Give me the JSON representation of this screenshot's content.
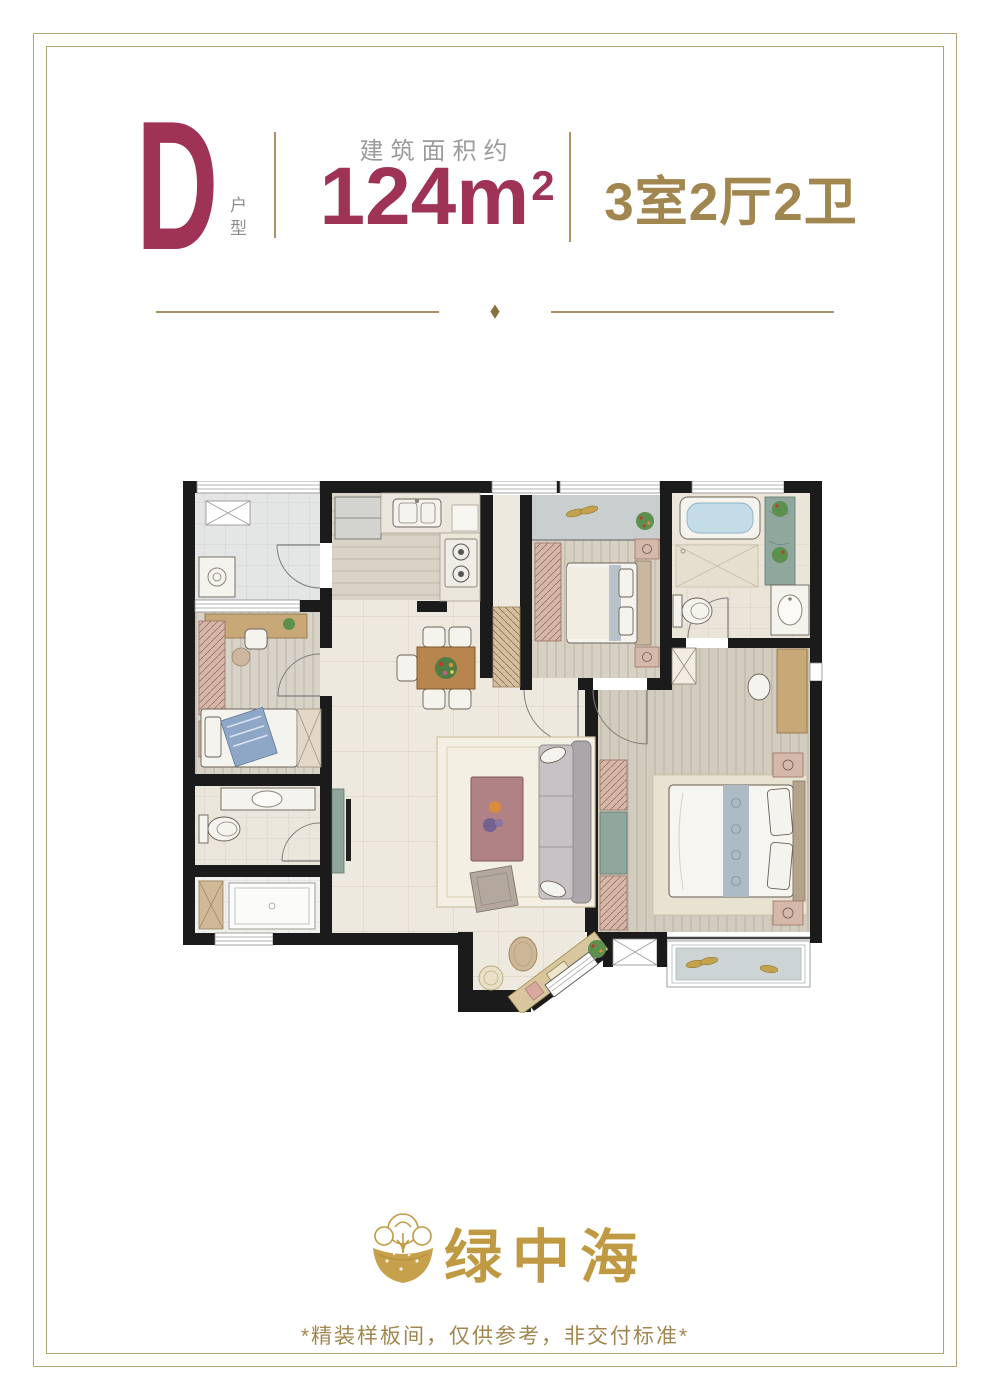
{
  "page": {
    "width": 990,
    "height": 1400,
    "background": "#ffffff",
    "frame_color": "#b6a477"
  },
  "header": {
    "unit_letter": "D",
    "unit_letter_color": "#9e3355",
    "unit_label": "户型",
    "area_caption": "建筑面积约",
    "area_value": "124m",
    "area_superscript": "2",
    "area_color": "#9e3355",
    "rooms_text": "3室2厅2卫",
    "rooms_color": "#a1874f",
    "caption_color": "#9b9b9b",
    "divider_color": "#a89366"
  },
  "section_divider": {
    "diamond": "◆",
    "line_color": "#a89366"
  },
  "floor_plan": {
    "wall_color": "#1b1b1b",
    "floor_color": "#eee9de",
    "accent_wood": "#c9a878",
    "accent_pink": "#d6b8aa",
    "accent_marble": "#8fa79c",
    "water_color": "#c3dce8"
  },
  "footer": {
    "brand_name": "绿中海",
    "brand_color": "#bf9a42",
    "disclaimer": "*精装样板间，仅供参考，非交付标准*",
    "disclaimer_color": "#a1874f"
  }
}
